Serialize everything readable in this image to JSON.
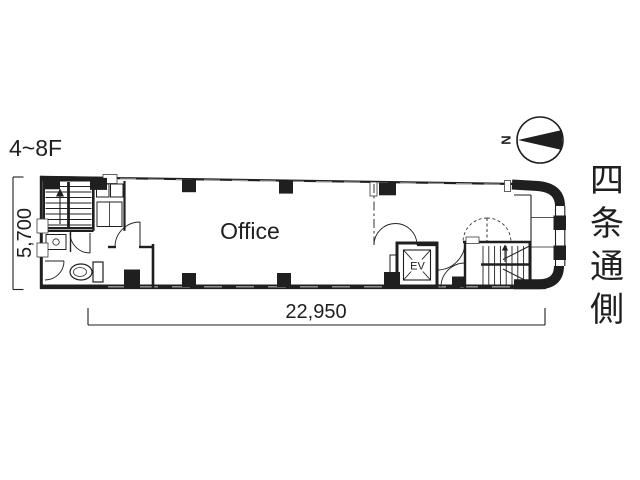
{
  "colors": {
    "ink": "#1f1f1f",
    "background": "#ffffff",
    "glazing_gray": "#9a9a9a"
  },
  "labels": {
    "floor_range": "4~8F",
    "office": "Office",
    "elevator": "EV",
    "north": "N"
  },
  "dimensions": {
    "width_mm": "22,950",
    "depth_mm": "5,700"
  },
  "street_side": {
    "label": "四条通側",
    "chars": [
      "四",
      "条",
      "通",
      "側"
    ]
  }
}
